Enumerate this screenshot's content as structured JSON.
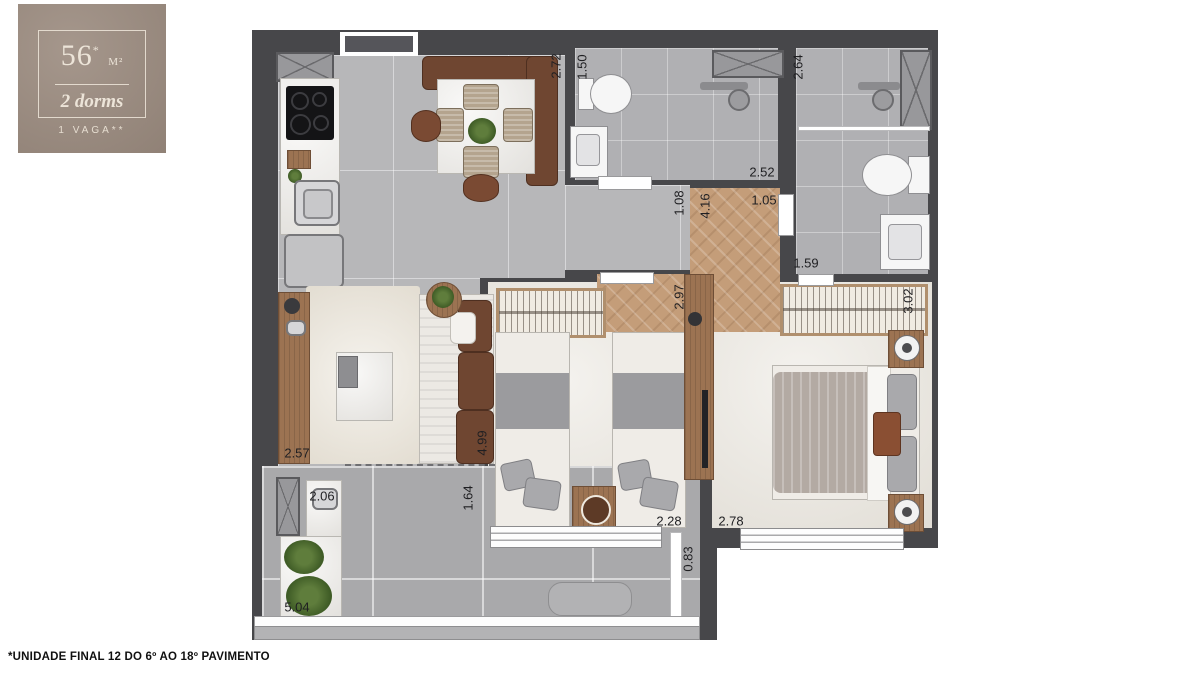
{
  "unit_card": {
    "area_value": "56",
    "area_asterisk": "*",
    "area_unit": "M²",
    "dorms_label": "2 dorms",
    "parking_label": "1 VAGA**"
  },
  "footnote": "*UNIDADE FINAL 12 DO 6º AO 18º PAVIMENTO",
  "floor_plan": {
    "dimensions_m": [
      {
        "v": "2.72",
        "x": 556,
        "y": 66,
        "r": true
      },
      {
        "v": "1.50",
        "x": 582,
        "y": 67,
        "r": true
      },
      {
        "v": "2.52",
        "x": 762,
        "y": 172,
        "r": false
      },
      {
        "v": "2.64",
        "x": 798,
        "y": 67,
        "r": true
      },
      {
        "v": "1.08",
        "x": 679,
        "y": 203,
        "r": true
      },
      {
        "v": "4.16",
        "x": 705,
        "y": 206,
        "r": true
      },
      {
        "v": "1.05",
        "x": 764,
        "y": 200,
        "r": false
      },
      {
        "v": "1.59",
        "x": 806,
        "y": 263,
        "r": false
      },
      {
        "v": "2.97",
        "x": 679,
        "y": 297,
        "r": true
      },
      {
        "v": "3.02",
        "x": 908,
        "y": 301,
        "r": true
      },
      {
        "v": "4.99",
        "x": 482,
        "y": 443,
        "r": true
      },
      {
        "v": "1.64",
        "x": 468,
        "y": 498,
        "r": true
      },
      {
        "v": "2.57",
        "x": 297,
        "y": 453,
        "r": false
      },
      {
        "v": "2.06",
        "x": 322,
        "y": 496,
        "r": false
      },
      {
        "v": "5.04",
        "x": 297,
        "y": 607,
        "r": false
      },
      {
        "v": "2.28",
        "x": 669,
        "y": 521,
        "r": false
      },
      {
        "v": "2.78",
        "x": 731,
        "y": 521,
        "r": false
      },
      {
        "v": "0.83",
        "x": 688,
        "y": 559,
        "r": true
      }
    ]
  },
  "colors": {
    "card_background": "#9b8b7f",
    "wall": "#47474a",
    "floor_tile": "#b7b7b9",
    "corridor_wood": "#c49d79",
    "carpet": "#e9e5dd"
  }
}
